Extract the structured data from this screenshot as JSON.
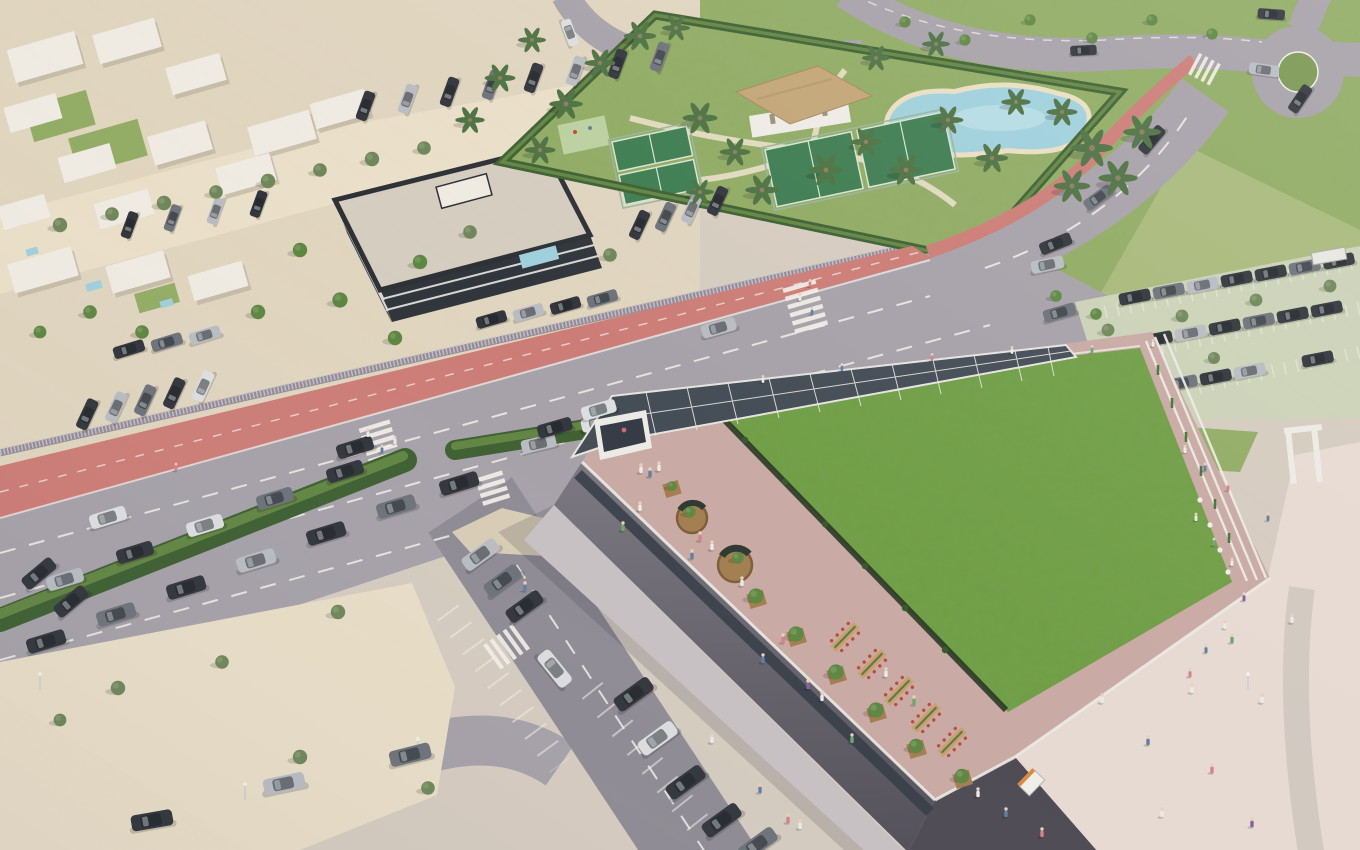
{
  "meta": {
    "description": "Aerial 3D architectural rendering of a coastal mixed-use development: a large commercial building with a planted green roof and rooftop promenade terrace, a diagonal boulevard with red cycle lane and hedge median, a resort amenity garden with lagoon pool, thatched clubhouse and padel courts, white residential villas, a dark apartment block, parking areas, a sandy vacant lot and a pedestrian esplanade with many people."
  },
  "colors": {
    "base": "#d6ccc0",
    "sand": "#e0d5bf",
    "sand_bright": "#eadfc8",
    "sand_shadow": "#cabca4",
    "asphalt": "#a7a2a9",
    "asphalt_dark": "#908c95",
    "road_line": "#f2efe9",
    "bike_lane": "#cd7d77",
    "fence": "#948c96",
    "fence_light": "#c6bfc8",
    "hedge": "#3f6133",
    "hedge_light": "#6d9048",
    "grass": "#93ad66",
    "grass_dark": "#7a9852",
    "grass_pale": "#a9ba7c",
    "roof_green": "#6f9e44",
    "roof_green_dark": "#567f33",
    "court": "#3f7d52",
    "court_line": "#d8e4d0",
    "pool": "#9fd0dc",
    "pool_light": "#c6e4ea",
    "beach": "#eadfc2",
    "thatch": "#c3a678",
    "clubhouse": "#efece6",
    "villa": "#efebe3",
    "villa_shadow": "#b3a896",
    "apt_roof": "#d5cdbf",
    "apt_dark": "#31363d",
    "apt_mid": "#4a5058",
    "apt_band": "#e9e7e3",
    "wall": "#75727b",
    "wall_dark": "#4e4b54",
    "parapet": "#eceae4",
    "glass": "#353c46",
    "terrace": "#c9aaa4",
    "esplanade": "#e7dad2",
    "cobble": "#d2c9c1",
    "solar": "#454d57",
    "solar_frame": "#e6e4df",
    "parking_green": "#ccd3b8",
    "wood": "#a37e50",
    "wood_dark": "#7c5f3a",
    "tree": "#5e8742",
    "tree_olive": "#70875a",
    "palm": "#4e7243",
    "trunk": "#8d7c63",
    "table": "#c8a070",
    "chair_red": "#c0483a",
    "island": "#d9cdb6",
    "tactile": "#e3cf7e",
    "lamp": "#d8dade",
    "shadow": "rgba(30,32,48,0.16)",
    "person_white": "#eceae6",
    "person_pink": "#d87f8a",
    "person_blue": "#5f7fa8",
    "person_green": "#6aa86f",
    "person_purple": "#8a5fa0",
    "car_dark": "#33373d",
    "car_gray": "#6e737b",
    "car_silver": "#b9bdc3",
    "car_white": "#dcdee0"
  },
  "scene": {
    "landmarks": [
      {
        "id": "green-roof-building",
        "label": "Commercial building with planted green roof and rooftop terrace"
      },
      {
        "id": "solar-canopy",
        "label": "Photovoltaic pergola over rooftop entrance"
      },
      {
        "id": "boulevard",
        "label": "Diagonal boulevard with red cycle lane and hedge median"
      },
      {
        "id": "amenity-garden",
        "label": "Resort garden with lagoon pool, clubhouse and padel courts"
      },
      {
        "id": "residential-district",
        "label": "White villas and apartment block"
      },
      {
        "id": "roundabout",
        "label": "Roundabout at top right"
      },
      {
        "id": "sand-lot",
        "label": "Vacant sandy lot bottom left"
      },
      {
        "id": "esplanade",
        "label": "Pedestrian esplanade bottom right"
      },
      {
        "id": "northeast-parking",
        "label": "Permeable-surface parking lot"
      }
    ]
  }
}
